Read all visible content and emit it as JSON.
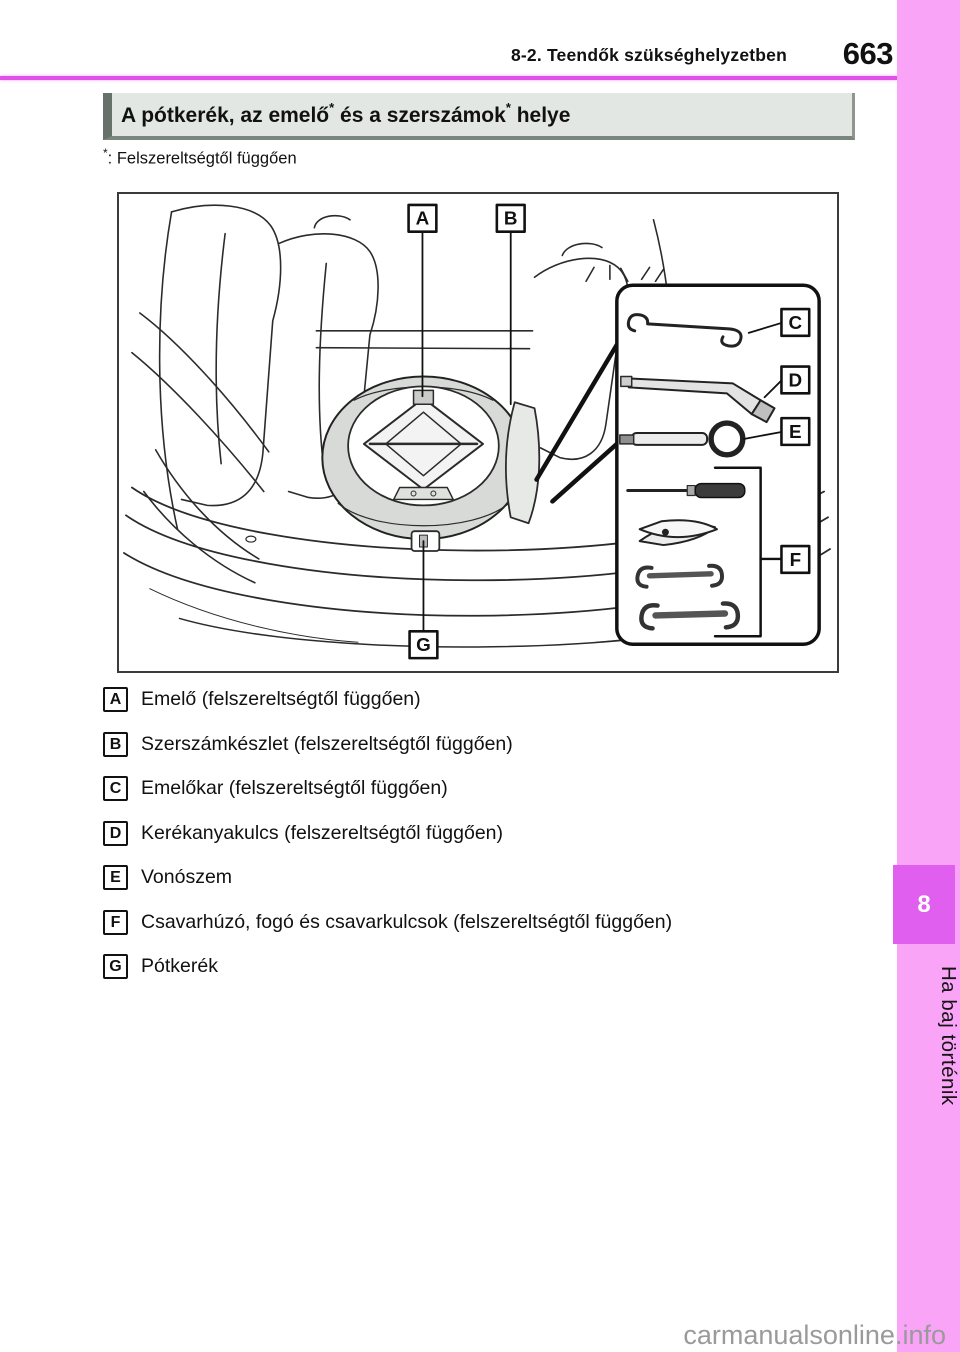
{
  "page": {
    "header": "8-2. Teendők szükséghelyzetben",
    "page_number": "663"
  },
  "section": {
    "title_part1": "A pótkerék, az emelő",
    "title_sup1": "*",
    "title_part2": " és a szerszámok",
    "title_sup2": "*",
    "title_part3": " helye"
  },
  "footnote": {
    "star": "*",
    "text": ": Felszereltségtől függően"
  },
  "diagram": {
    "labels": [
      "A",
      "B",
      "C",
      "D",
      "E",
      "F",
      "G"
    ]
  },
  "legend": [
    {
      "letter": "A",
      "text": "Emelő (felszereltségtől függően)"
    },
    {
      "letter": "B",
      "text": "Szerszámkészlet (felszereltségtől függően)"
    },
    {
      "letter": "C",
      "text": "Emelőkar (felszereltségtől függően)"
    },
    {
      "letter": "D",
      "text": "Kerékanyakulcs (felszereltségtől függően)"
    },
    {
      "letter": "E",
      "text": "Vonószem"
    },
    {
      "letter": "F",
      "text": "Csavarhúzó, fogó és csavarkulcsok (felszereltségtől függően)"
    },
    {
      "letter": "G",
      "text": "Pótkerék"
    }
  ],
  "sidebar": {
    "chapter_number": "8",
    "chapter_label": "Ha baj történik"
  },
  "watermark": "carmanualsonline.info",
  "colors": {
    "band_pink": "#f9a4f6",
    "chapter_tab_magenta": "#e05fee",
    "rule_magenta": "#de52e9",
    "titlebar_bg": "#e3e7e3",
    "titlebar_accent": "#66716c",
    "tire_gray": "#d7dad7",
    "watermark_gray": "#9a9a9a"
  }
}
